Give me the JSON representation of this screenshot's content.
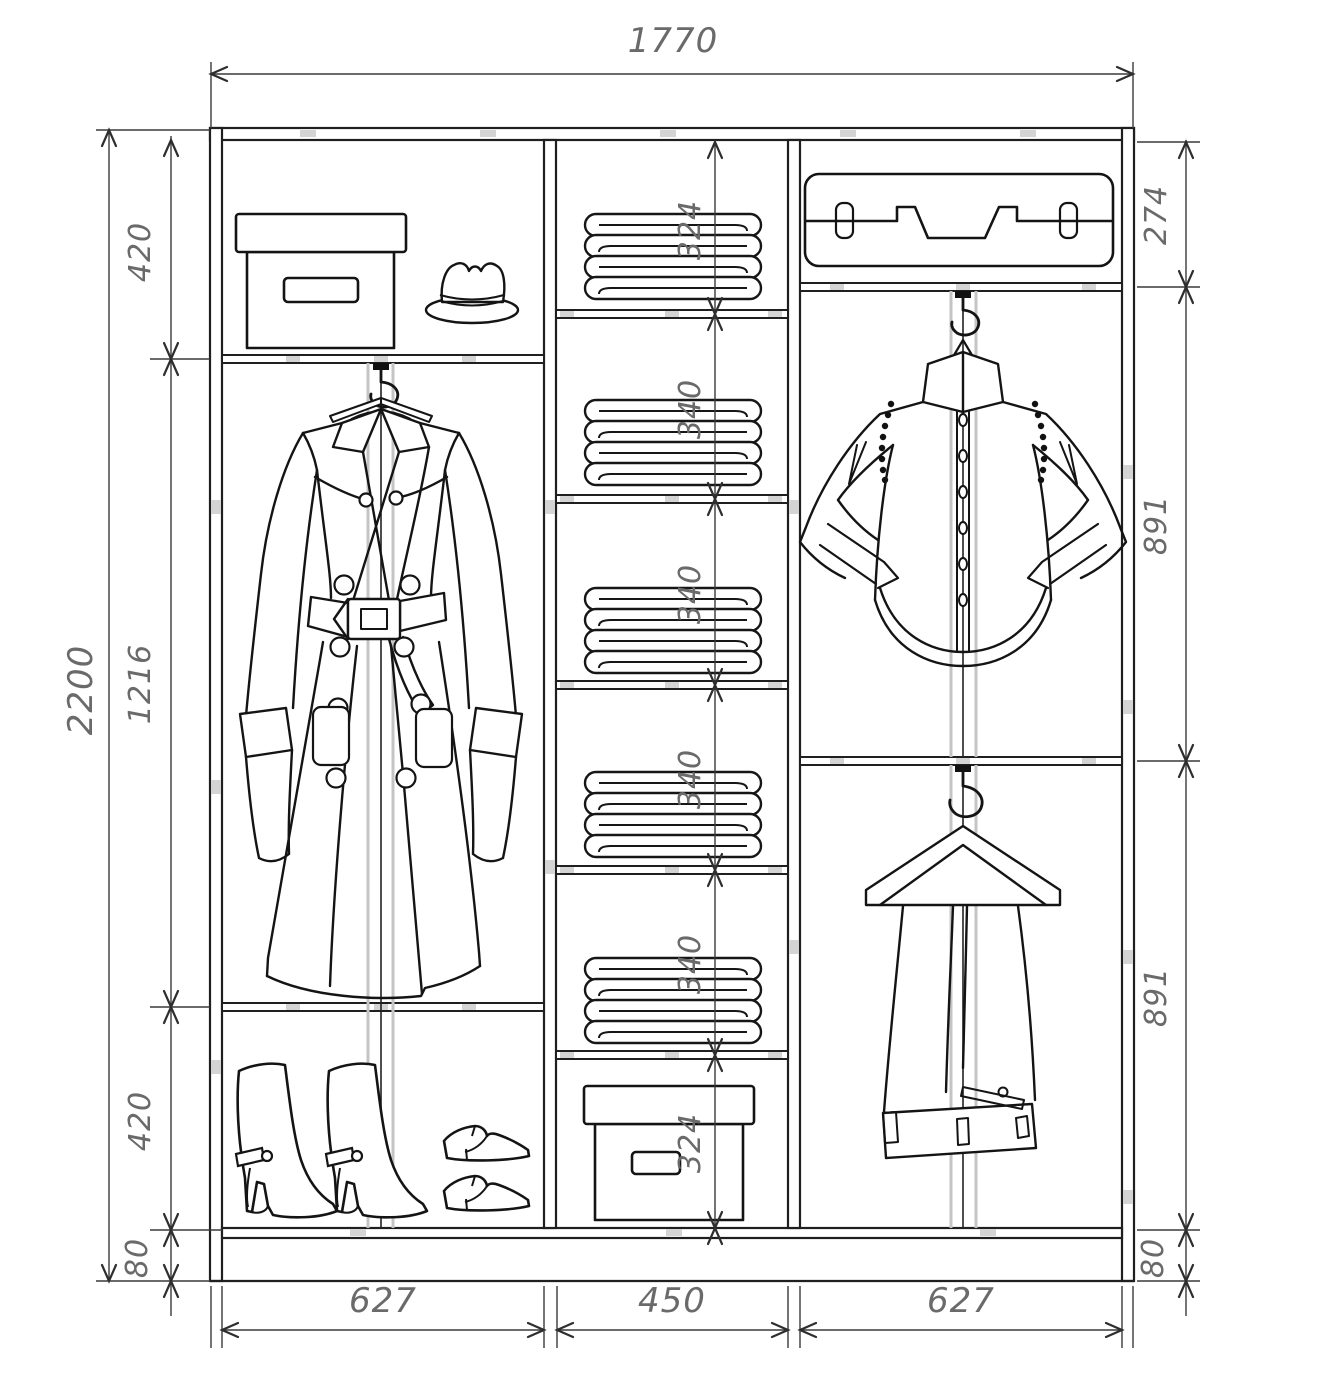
{
  "drawing": {
    "type": "furniture-technical-drawing",
    "subject": "sliding wardrobe interior elevation with dimensions",
    "units": "mm",
    "colors": {
      "ink": "#1f1f1f",
      "dim_line": "#3a3a3a",
      "label": "#6a6a6a",
      "rod_gray": "#c4c4c4",
      "connector_gray": "#d4d4d4",
      "background": "#ffffff"
    }
  },
  "dims": {
    "overall_width": "1770",
    "overall_height": "2200",
    "left_sections": [
      "420",
      "1216",
      "420",
      "80"
    ],
    "middle_sections": [
      "324",
      "340",
      "340",
      "340",
      "340",
      "324"
    ],
    "right_sections": [
      "274",
      "891",
      "891",
      "80"
    ],
    "section_widths": [
      "627",
      "450",
      "627"
    ]
  },
  "items": {
    "top_left_shelf": [
      "storage-box",
      "hat"
    ],
    "left_section": [
      "trench-coat-on-hanger",
      "hanging-rod"
    ],
    "bottom_left_shelf": [
      "boots-pair",
      "dress-shoes-pair"
    ],
    "middle_column": [
      "folded-linen-stack",
      "folded-linen-stack",
      "folded-linen-stack",
      "folded-linen-stack",
      "folded-linen-stack",
      "storage-box"
    ],
    "right_top_shelf": [
      "suitcase"
    ],
    "right_upper_section": [
      "dress-shirt-on-hanger",
      "hanging-rod"
    ],
    "right_lower_section": [
      "trousers-on-hanger",
      "hanging-rod"
    ]
  }
}
